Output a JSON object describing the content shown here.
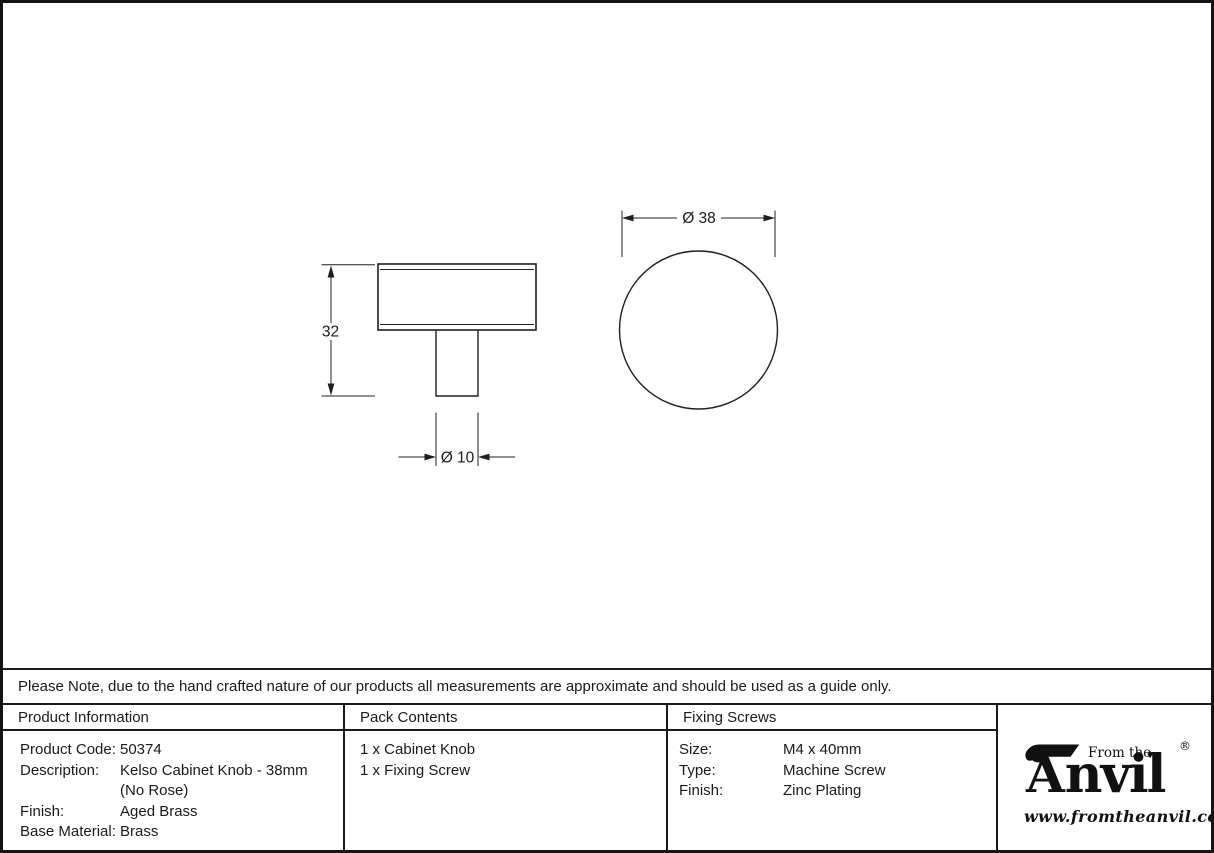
{
  "note": "Please Note, due to the hand crafted nature of our products all measurements are approximate and should be used as a guide only.",
  "drawing": {
    "dim_height": "32",
    "dim_stem_diameter": "Ø 10",
    "dim_knob_diameter": "Ø 38"
  },
  "table": {
    "product_information": {
      "header": "Product Information",
      "rows": [
        {
          "label": "Product Code:",
          "value": "50374"
        },
        {
          "label": "Description:",
          "value": "Kelso Cabinet Knob - 38mm"
        },
        {
          "label": "",
          "value": "(No Rose)"
        },
        {
          "label": "Finish:",
          "value": "Aged Brass"
        },
        {
          "label": "Base Material:",
          "value": "Brass"
        }
      ]
    },
    "pack_contents": {
      "header": "Pack Contents",
      "items": [
        "1 x Cabinet Knob",
        "1 x Fixing Screw"
      ]
    },
    "fixing_screws": {
      "header": "Fixing Screws",
      "rows": [
        {
          "label": "Size:",
          "value": "M4 x 40mm"
        },
        {
          "label": "Type:",
          "value": "Machine Screw"
        },
        {
          "label": "Finish:",
          "value": "Zinc Plating"
        }
      ]
    }
  },
  "logo": {
    "from_the": "From the",
    "brand_initial": "A",
    "brand_rest": "nvil",
    "registered": "®",
    "diamond": "♦",
    "url": "www.fromtheanvil.co.uk"
  },
  "colors": {
    "ink": "#1a1a1a",
    "background": "#ffffff"
  }
}
